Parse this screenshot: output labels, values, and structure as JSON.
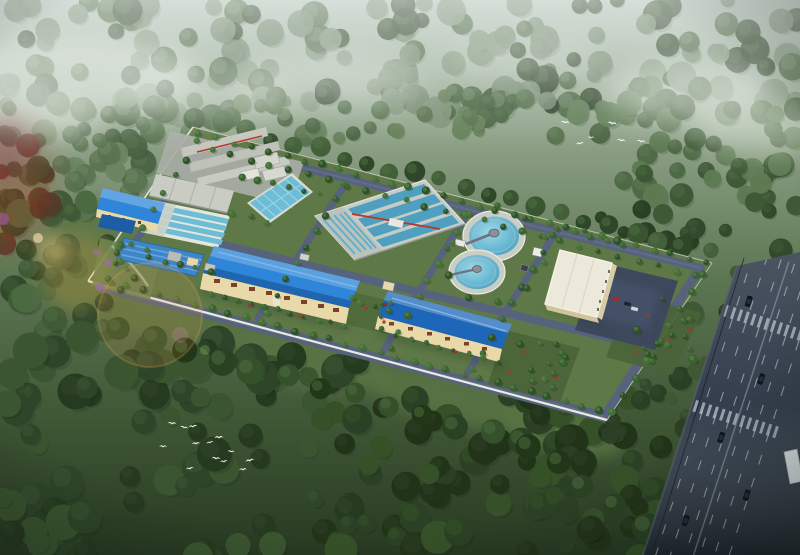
{
  "meta": {
    "width": 800,
    "height": 555,
    "type": "3d-aerial-architectural-rendering",
    "subject": "Bird's-eye rendering of a wastewater treatment plant compound in a forest clearing, hazy daylight, multi-lane road at right edge"
  },
  "environment": {
    "forest": "dense broadleaf forest surrounding the site, misty at top",
    "fog": "white mist drifting over the treetops along the upper edge",
    "lawn": "open grass clearing south and west of the plant wall",
    "lens_flare": "warm orange lens-flare rings at the left edge",
    "bird_flocks": [
      {
        "location": "top-right",
        "count": 6
      },
      {
        "location": "bottom-left",
        "count": 13
      }
    ]
  },
  "site": {
    "boundary": "walled rectangular compound seen in oblique aerial view",
    "facilities": [
      {
        "id": "gray-sheds",
        "label": "process building complex with red pipework"
      },
      {
        "id": "pump-house",
        "label": "blue-roof pump station"
      },
      {
        "id": "lamella-tanks",
        "label": "inclined-plate sedimentation tanks"
      },
      {
        "id": "covered-tank",
        "label": "blue-paneled covered tank"
      },
      {
        "id": "clear-water-pool",
        "label": "rectangular clear-water basin with walkway grid"
      },
      {
        "id": "aeration-basin",
        "label": "multi-channel aeration basin with red pipe bridge"
      },
      {
        "id": "clarifier-1",
        "label": "circular clarifier with center scraper bridge"
      },
      {
        "id": "clarifier-2",
        "label": "circular clarifier with center scraper bridge"
      },
      {
        "id": "admin-building",
        "label": "white flat-roof administration building"
      },
      {
        "id": "parking-lot",
        "label": "asphalt parking area with cars"
      },
      {
        "id": "workshop-1",
        "label": "large blue-roof production workshop"
      },
      {
        "id": "workshop-2",
        "label": "second blue-roof workshop"
      },
      {
        "id": "internal-roads",
        "label": "asphalt loop roads lined with poplars"
      },
      {
        "id": "landscaping",
        "label": "tree rows, red flowering shrubs, corner garden"
      }
    ],
    "parking_car_count": 4
  },
  "highway": {
    "label": "multi-lane urban road along right edge",
    "features": [
      "lane dashes",
      "two zebra crosswalks",
      "dark cars",
      "white truck",
      "utility line"
    ],
    "car_count": 5
  },
  "colors": {
    "mistTop": "#b9c6bd",
    "forestLight": "#74886f",
    "forestMid": "#49653f",
    "forestDark": "#2c4026",
    "lawn": "#5a7444",
    "siteGrass": "#5f7847",
    "roadSite": "#57637c",
    "roadHighway": "#2e3948",
    "wall": "#e4e7dc",
    "roofBlue": "#2f86d8",
    "roofBlueDark": "#1e66b8",
    "cream": "#ead9a8",
    "concrete": "#c6cbc4",
    "grayRoof": "#c5c7be",
    "water": "#6fbcd6",
    "waterDeep": "#4fa0c0",
    "redPipe": "#b5382a",
    "treeRow": "#3c6132",
    "shrubRed": "#a83430",
    "flowerPurple": "#8a63b8",
    "birdWhite": "#f5f8f5",
    "flareOrange": "#e8a03c",
    "carDark": "#10151d"
  }
}
